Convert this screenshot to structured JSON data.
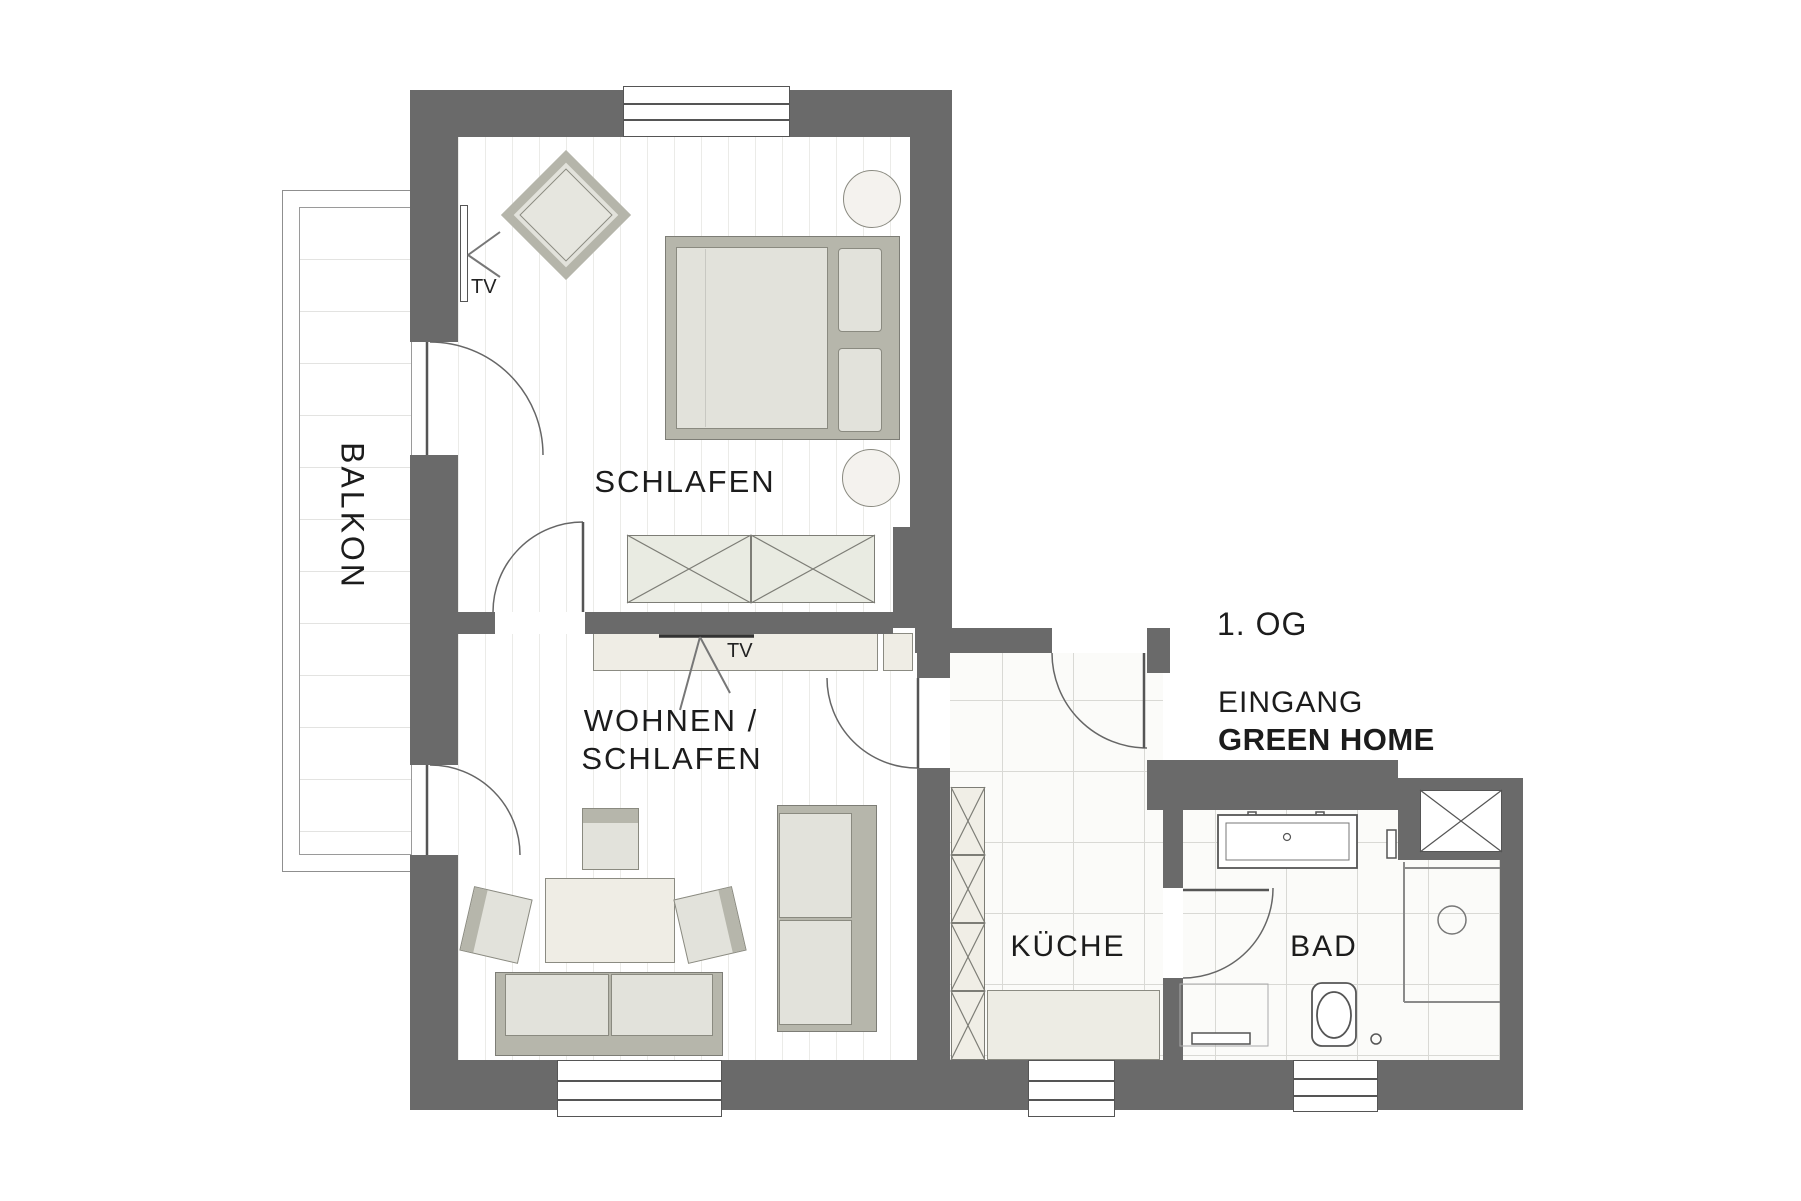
{
  "plan": {
    "floor_label": "1. OG",
    "entrance": {
      "line1": "EINGANG",
      "line2": "GREEN HOME"
    },
    "rooms": {
      "balkon": "BALKON",
      "schlafen": "SCHLAFEN",
      "wohnen_line1": "WOHNEN /",
      "wohnen_line2": "SCHLAFEN",
      "kueche": "KÜCHE",
      "bad": "BAD"
    },
    "labels": {
      "tv_bedroom": "TV",
      "tv_living": "TV"
    },
    "colors": {
      "wall": "#6a6a6a",
      "outline": "#555555",
      "furniture_band": "#b6b6ab",
      "furniture_light": "#e2e2db",
      "furniture_beige": "#efede5",
      "floor_line": "#ebebe8",
      "tile_line": "#d9d9d5"
    }
  }
}
